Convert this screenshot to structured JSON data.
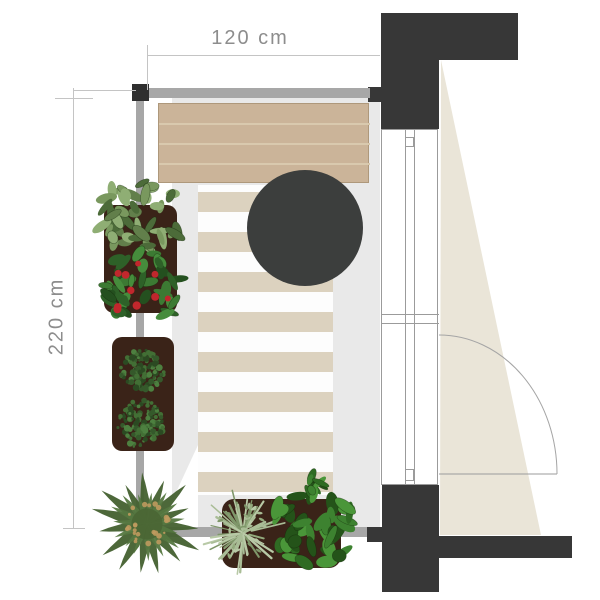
{
  "annotations": {
    "width_label": "120 cm",
    "height_label": "220 cm"
  },
  "palette": {
    "background": "#ffffff",
    "wall": "#373737",
    "railing": "#a7a7a7",
    "railing_post": "#2f2f2f",
    "floor": "#e9e9e9",
    "floor_highlight": "#ffffff",
    "rug": "#fdfdfd",
    "rug_stripe": "#dcd2bf",
    "bench": "#cbb499",
    "bench_line": "#d9c9ae",
    "table": "#3c3e3d",
    "frame_line": "#9b9b9b",
    "light_triangle": "#eae5d8",
    "planter": "#3a2318",
    "dim_line": "#c4c4c4",
    "dim_text": "#8d8d8d",
    "berry": "#c1272d",
    "palm_speckle": "#bf9a5e"
  },
  "plan": {
    "floor": {
      "name": "balcony-floor",
      "x": 172,
      "y": 98,
      "w": 208,
      "h": 439
    },
    "floor_highlight": [
      [
        198,
        445
      ],
      [
        198,
        527
      ],
      [
        160,
        527
      ]
    ],
    "rug": {
      "name": "striped-rug",
      "x": 198,
      "y": 185,
      "w": 135,
      "h": 310,
      "stripe_start": 192,
      "stripe_h": 20,
      "stripe_gap": 20,
      "stripe_count": 8
    },
    "bench": {
      "name": "wooden-bench",
      "x": 158,
      "y": 103,
      "w": 211,
      "h": 80,
      "lines": [
        19,
        39,
        59
      ]
    },
    "table": {
      "name": "round-table",
      "cx": 305,
      "cy": 228,
      "r": 58
    },
    "walls": [
      {
        "name": "wall-top-horizontal",
        "x": 381,
        "y": 13,
        "w": 137,
        "h": 47
      },
      {
        "name": "wall-top-vertical",
        "x": 381,
        "y": 56,
        "w": 58,
        "h": 73
      },
      {
        "name": "wall-railing-stub-top",
        "x": 368,
        "y": 87,
        "w": 14,
        "h": 15
      },
      {
        "name": "wall-bottom-vertical",
        "x": 382,
        "y": 485,
        "w": 57,
        "h": 107
      },
      {
        "name": "wall-bottom-horizontal",
        "x": 439,
        "y": 536,
        "w": 133,
        "h": 22
      },
      {
        "name": "wall-railing-stub-bottom",
        "x": 367,
        "y": 527,
        "w": 16,
        "h": 15
      }
    ],
    "railing": [
      {
        "name": "railing-top-bar",
        "x": 140,
        "y": 88,
        "w": 230,
        "h": 10
      },
      {
        "name": "railing-left-bar",
        "x": 136,
        "y": 98,
        "w": 8,
        "h": 439
      },
      {
        "name": "railing-bottom-bar",
        "x": 136,
        "y": 527,
        "w": 231,
        "h": 10
      }
    ],
    "railing_posts": [
      {
        "name": "railing-post-top-left",
        "x": 132,
        "y": 84,
        "w": 17,
        "h": 17
      }
    ],
    "frame": {
      "name": "door-window-frame",
      "x": 381,
      "y": 129,
      "w": 57,
      "h": 356,
      "v_lines": [
        404,
        413
      ],
      "h_lines": [
        313,
        322
      ],
      "ticks": [
        {
          "x": 404,
          "y": 136,
          "w": 9,
          "h": 10
        },
        {
          "x": 404,
          "y": 468,
          "w": 9,
          "h": 12
        }
      ]
    },
    "door": {
      "name": "door-swing",
      "hinge_x": 439,
      "hinge_y": 474,
      "rx": 118,
      "ry": 139,
      "leaf_to_x": 557
    },
    "light_triangle": [
      [
        441,
        60
      ],
      [
        541,
        535
      ],
      [
        440,
        535
      ]
    ],
    "planters": [
      {
        "name": "planter-left-upper",
        "x": 104,
        "y": 205,
        "w": 73,
        "h": 108,
        "r": 10
      },
      {
        "name": "planter-left-lower",
        "x": 112,
        "y": 337,
        "w": 62,
        "h": 114,
        "r": 10
      },
      {
        "name": "planter-bottom",
        "x": 222,
        "y": 499,
        "w": 119,
        "h": 69,
        "r": 12
      }
    ],
    "plants": [
      {
        "name": "plant-mint",
        "type": "leafy",
        "cx": 139,
        "cy": 217,
        "r": 44,
        "n": 46,
        "leaf": [
          9,
          4
        ],
        "colors": [
          "#8fae74",
          "#79985e",
          "#627f4b",
          "#4c6b39"
        ]
      },
      {
        "name": "plant-strawberry",
        "type": "leafy",
        "cx": 142,
        "cy": 287,
        "r": 40,
        "n": 40,
        "leaf": [
          8,
          4
        ],
        "colors": [
          "#3c7a33",
          "#2e6128",
          "#24501f",
          "#468c3c"
        ],
        "berries": {
          "n": 10,
          "r": 3.2,
          "color": "#c1272d"
        }
      },
      {
        "name": "plant-bush-upper",
        "type": "mottled",
        "cx": 142,
        "cy": 371,
        "r": 23,
        "n": 110,
        "colors": [
          "#426f35",
          "#35592b",
          "#4d8040",
          "#2b4a22"
        ]
      },
      {
        "name": "plant-bush-lower",
        "type": "mottled",
        "cx": 141,
        "cy": 424,
        "r": 25,
        "n": 120,
        "colors": [
          "#426f35",
          "#35592b",
          "#4d8040",
          "#2b4a22"
        ]
      },
      {
        "name": "plant-palm",
        "type": "palm",
        "cx": 147,
        "cy": 524,
        "r": 52,
        "colors": [
          "#43602f",
          "#557740"
        ],
        "speckle": "#bf9a5e"
      },
      {
        "name": "plant-feathery",
        "type": "feathery",
        "cx": 243,
        "cy": 533,
        "r": 40,
        "n": 55,
        "colors": [
          "#a9bd96",
          "#93ab7d",
          "#b8c9a6",
          "#7f976a"
        ]
      },
      {
        "name": "plant-leafy-green",
        "type": "leafy",
        "cx": 312,
        "cy": 527,
        "r": 43,
        "n": 42,
        "leaf": [
          10,
          5
        ],
        "colors": [
          "#2f6b23",
          "#3d8230",
          "#245319",
          "#4a9639"
        ]
      },
      {
        "name": "plant-leafy-green-sprig",
        "type": "leafy",
        "cx": 313,
        "cy": 485,
        "r": 13,
        "n": 9,
        "leaf": [
          7,
          3
        ],
        "colors": [
          "#2f6b23",
          "#3d8230",
          "#245319",
          "#4a9639"
        ]
      }
    ],
    "dimensions": {
      "top": {
        "line": {
          "x1": 147,
          "y": 55,
          "x2": 380
        },
        "tick": {
          "x": 147,
          "y1": 45,
          "y2": 90
        },
        "label_center": {
          "x": 250,
          "y": 40
        }
      },
      "left": {
        "line": {
          "x": 73,
          "y1": 88,
          "y2": 528
        },
        "ext": {
          "y": 90,
          "x1": 73,
          "x2": 136
        },
        "tick_top": {
          "y": 98,
          "x1": 55,
          "x2": 93
        },
        "tick_bottom": {
          "y": 528,
          "x1": 63,
          "x2": 85
        },
        "label_center": {
          "x": 57,
          "y": 318
        }
      }
    }
  }
}
